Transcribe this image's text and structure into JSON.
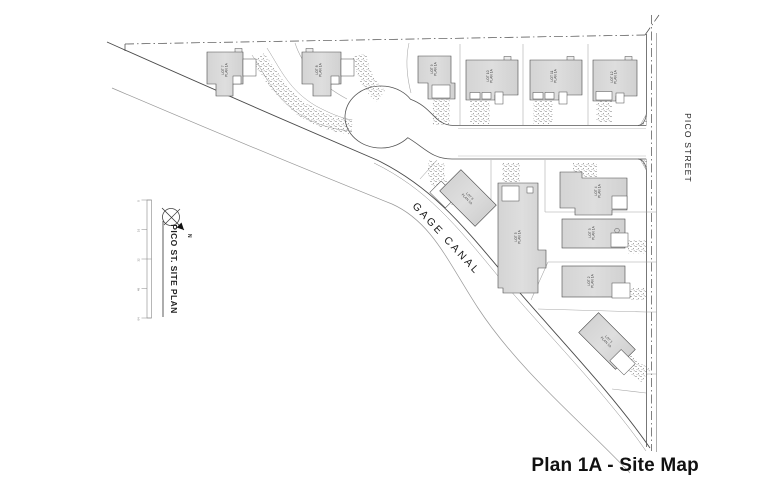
{
  "drawing": {
    "title": "Plan 1A - Site Map",
    "sheet_label": "PICO ST. SITE PLAN",
    "street_label": "PICO STREET",
    "canal_label": "GAGE CANAL",
    "north_label": "N"
  },
  "scale_bar": {
    "ticks": [
      "0",
      "16",
      "32",
      "48",
      "64"
    ]
  },
  "lots": [
    {
      "label": "LOT 1",
      "plan": "PLAN 1A"
    },
    {
      "label": "LOT 2",
      "plan": "PLAN 1A"
    },
    {
      "label": "LOT 3",
      "plan": "PLAN 1A"
    },
    {
      "label": "LOT 4",
      "plan": "PLAN 1A"
    },
    {
      "label": "LOT 5",
      "plan": "PLAN 1A"
    },
    {
      "label": "LOT 6",
      "plan": "PLAN 1A"
    },
    {
      "label": "LOT 7",
      "plan": "PLAN 1A"
    },
    {
      "label": "LOT 8",
      "plan": "PLAN 1A"
    },
    {
      "label": "LOT 9",
      "plan": "PLAN 1A"
    },
    {
      "label": "LOT 10",
      "plan": "PLAN 1A"
    },
    {
      "label": "LOT 11",
      "plan": "PLAN 1A"
    },
    {
      "label": "LOT 12",
      "plan": "PLAN 1A"
    }
  ],
  "colors": {
    "background": "#ffffff",
    "linework": "#4a4a4a",
    "light_line": "#9a9a9a",
    "house_fill": "#d8d8d8",
    "text": "#1a1a1a"
  }
}
